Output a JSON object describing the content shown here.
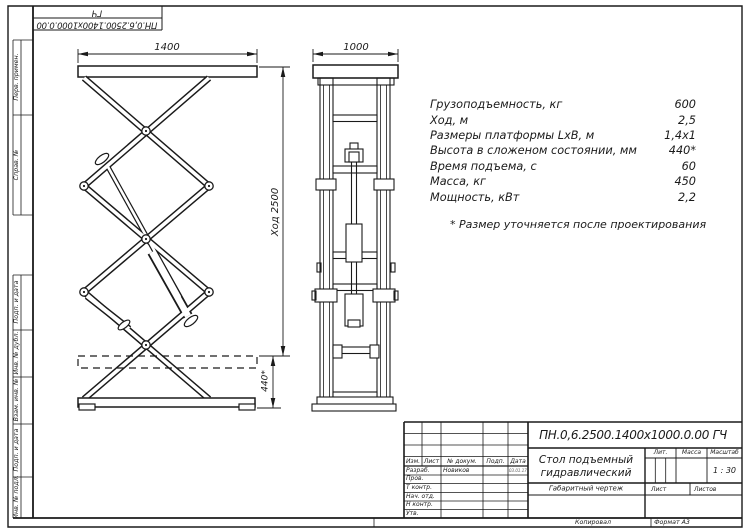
{
  "sheet": {
    "corner_stamp": {
      "line1": "ПН.0,6.2500.1400х1000.0.00",
      "line2": "ГЧ"
    },
    "margin_labels": [
      "Перв. примен.",
      "Справ. №",
      "Подп. и дата",
      "Инв. № дубл.",
      "Взам. инв. №",
      "Подп. и дата",
      "Инв. № подл."
    ],
    "footer": {
      "copied": "Копировал",
      "format": "Формат А3"
    }
  },
  "views": {
    "front": {
      "width_dim": "1400",
      "stroke_dim": "Ход 2500",
      "folded_dim": "440*"
    },
    "side": {
      "width_dim": "1000"
    }
  },
  "specs": {
    "rows": [
      {
        "label": "Грузоподъемность, кг",
        "value": "600"
      },
      {
        "label": "Ход, м",
        "value": "2,5"
      },
      {
        "label": "Размеры платформы LхВ, м",
        "value": "1,4х1"
      },
      {
        "label": "Высота в сложеном состоянии, мм",
        "value": "440*"
      },
      {
        "label": "Время подъема, с",
        "value": "60"
      },
      {
        "label": "Масса, кг",
        "value": "450"
      },
      {
        "label": "Мощность, кВт",
        "value": "2,2"
      }
    ],
    "note": "* Размер уточняется после проектирования"
  },
  "title_block": {
    "designation": "ПН.0,6.2500.1400х1000.0.00 ГЧ",
    "title_line1": "Стол подъемный",
    "title_line2": "гидравлический",
    "doc_type": "Габаритный чертеж",
    "rev_headers": [
      "Изм.",
      "Лист",
      "№ докум.",
      "Подп.",
      "Дата"
    ],
    "roles": [
      {
        "role": "Разраб.",
        "name": "Новиков",
        "date": "03.01.17"
      },
      {
        "role": "Пров.",
        "name": "",
        "date": ""
      },
      {
        "role": "Т контр.",
        "name": "",
        "date": ""
      },
      {
        "role": "Нач. отд.",
        "name": "",
        "date": ""
      },
      {
        "role": "Н контр.",
        "name": "",
        "date": ""
      },
      {
        "role": "Утв.",
        "name": "",
        "date": ""
      }
    ],
    "lit_label": "Лит.",
    "mass_label": "Масса",
    "scale_label": "Масштаб",
    "scale_value": "1 : 30",
    "sheet_label": "Лист",
    "sheets_label": "Листов"
  }
}
